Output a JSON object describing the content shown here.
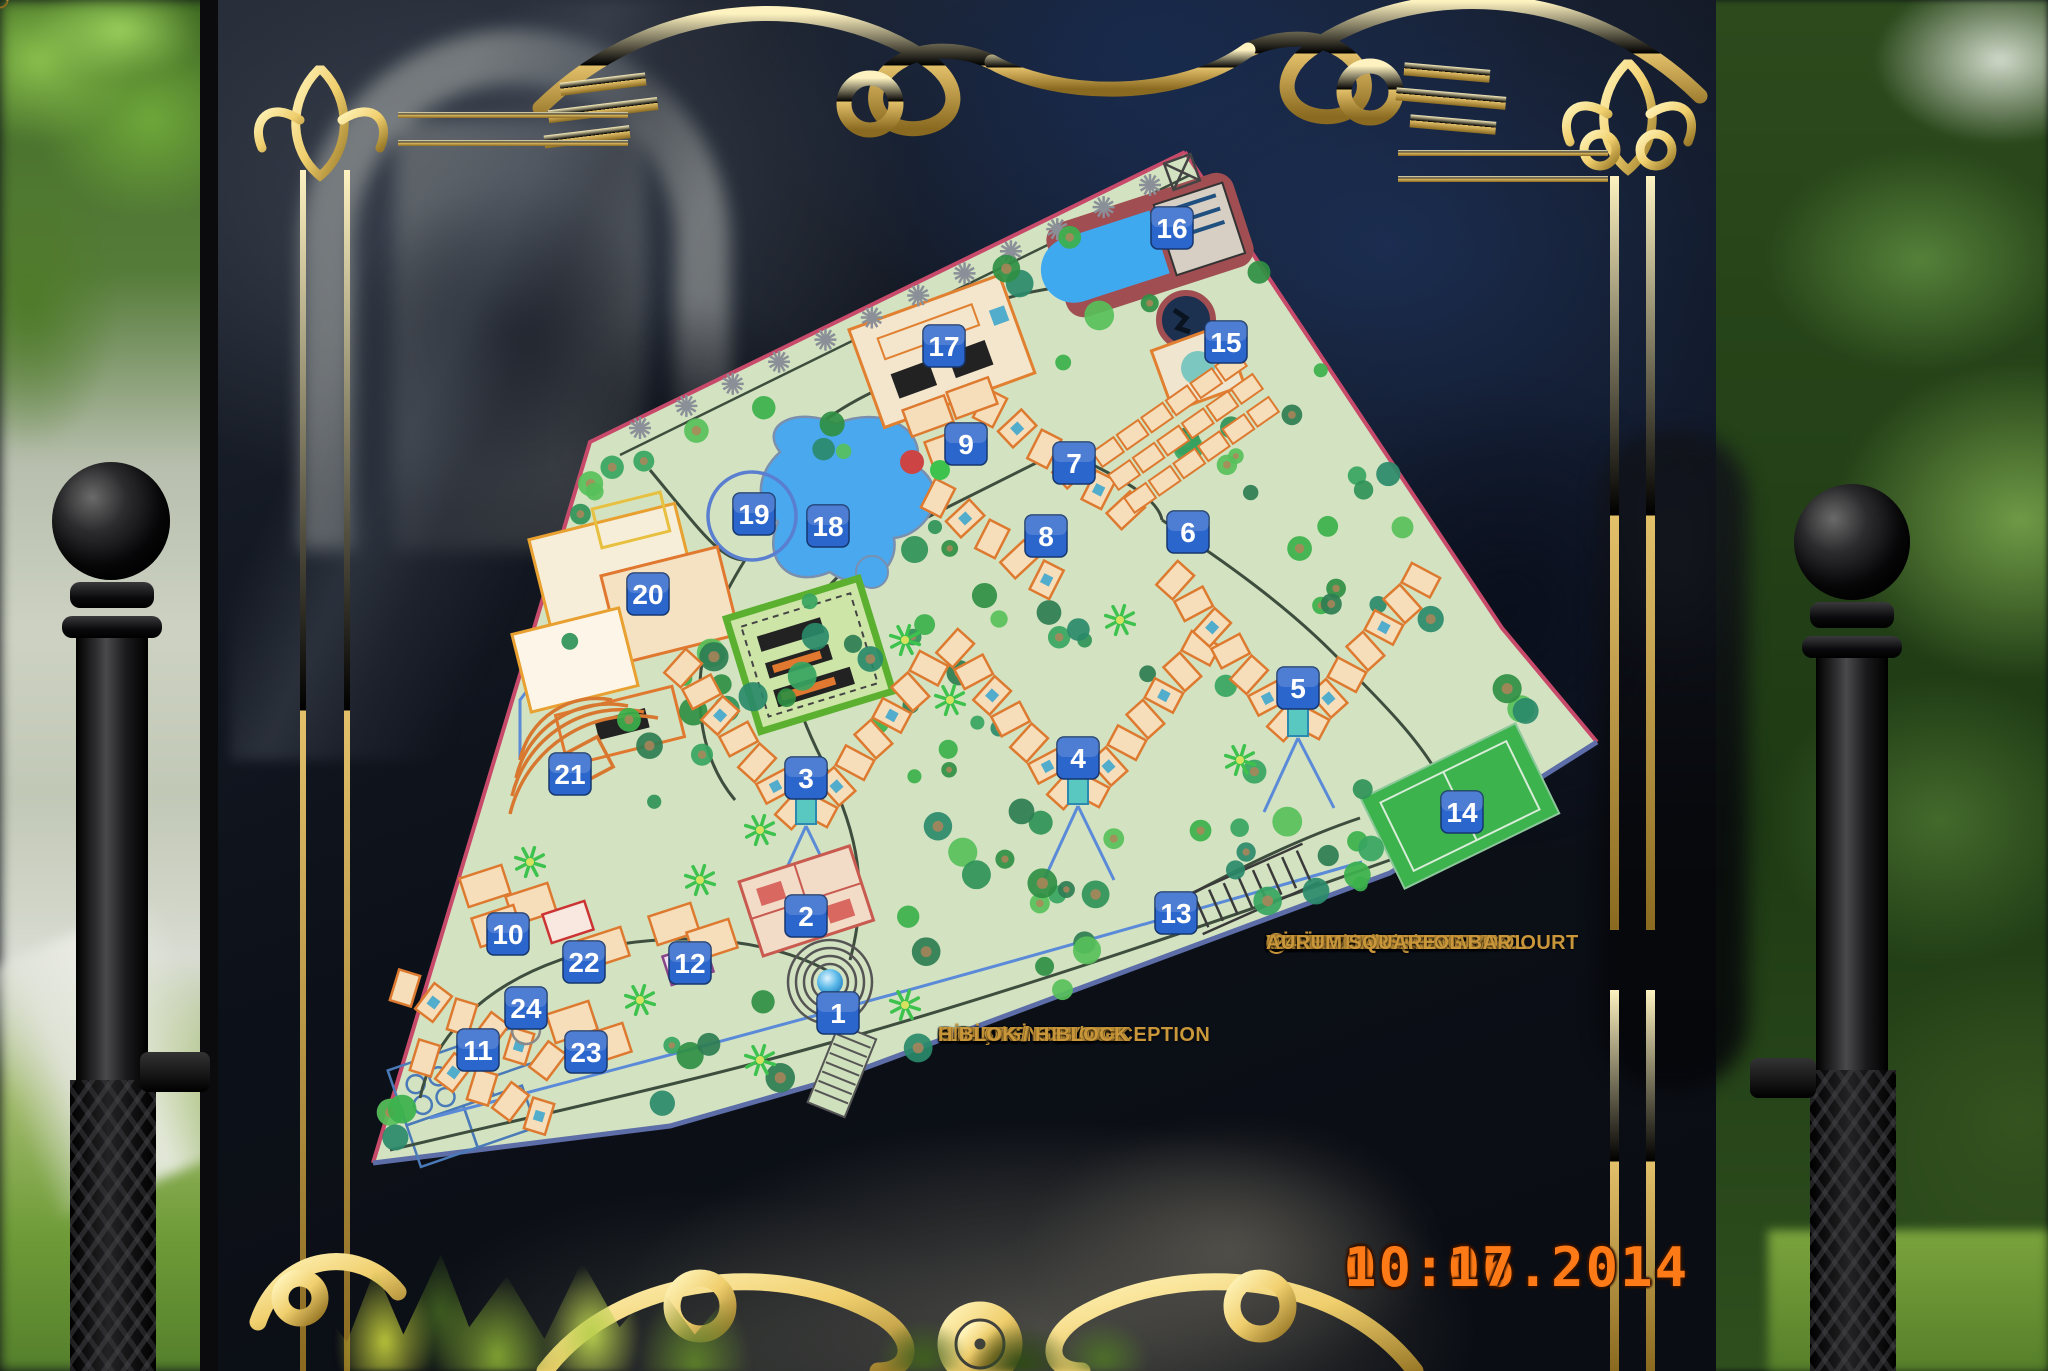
{
  "sign": {
    "legend_left": [
      {
        "n": "1-",
        "t": "GİRİŞ / ENTRY"
      },
      {
        "n": "2-",
        "t": "RESEPSİYON / RECEPTION"
      },
      {
        "n": "3-",
        "t": "A BLOK / A BLOCK"
      },
      {
        "n": "4-",
        "t": "B BLOK / B BLOCK"
      },
      {
        "n": "5-",
        "t": "C BLOK / C BLOCK"
      },
      {
        "n": "6-",
        "t": "D BLOK / D BLOCK"
      },
      {
        "n": "7-",
        "t": "E BLOK / E BLOCK"
      },
      {
        "n": "8-",
        "t": "F BLOK / F BLOCK"
      },
      {
        "n": "9-",
        "t": "G BLOK / G BLOCK"
      },
      {
        "n": "10-",
        "t": "H BLOK / H BLOCK"
      }
    ],
    "legend_right": [
      {
        "n": "11-",
        "t": "K BLOK / K BLOCK"
      },
      {
        "n": "12-",
        "t": "VAHA WELLNESS & SPA"
      },
      {
        "n": "13-",
        "t": "OTOPARK / CARPARK"
      },
      {
        "n": "14-",
        "t": "TENİS KORTU / TENNIS COURT"
      },
      {
        "n": "15-",
        "t": "MİNİCLUB / MINICLUB"
      },
      {
        "n": "16-",
        "t": "SU PARKI / AQUAPARK"
      },
      {
        "n": "17-",
        "t": "SNACK BAR"
      },
      {
        "n": "18-",
        "t": "HAVUZ / SWIMMING POOL"
      },
      {
        "n": "19-",
        "t": "HAVUZ BAR / POOL BAR"
      },
      {
        "n": "20-",
        "t": "RESTAURANT",
        "circle": "10"
      },
      {
        "n": "21-",
        "t": "AMPHITHEATRE"
      },
      {
        "n": "22-",
        "t": "CAFE BELLIS"
      },
      {
        "n": "23-",
        "t": "NORTH BAR"
      },
      {
        "n": "24-",
        "t": "AURUM SQUARE"
      }
    ],
    "timestamp": {
      "date": "08.06.2014",
      "time": "10:17"
    }
  },
  "map": {
    "markers": [
      {
        "num": "1",
        "x": 838,
        "y": 1013
      },
      {
        "num": "2",
        "x": 806,
        "y": 916
      },
      {
        "num": "3",
        "x": 806,
        "y": 778
      },
      {
        "num": "4",
        "x": 1078,
        "y": 758
      },
      {
        "num": "5",
        "x": 1298,
        "y": 688
      },
      {
        "num": "6",
        "x": 1188,
        "y": 532
      },
      {
        "num": "7",
        "x": 1074,
        "y": 463
      },
      {
        "num": "8",
        "x": 1046,
        "y": 536
      },
      {
        "num": "9",
        "x": 966,
        "y": 444
      },
      {
        "num": "10",
        "x": 508,
        "y": 934
      },
      {
        "num": "11",
        "x": 478,
        "y": 1050
      },
      {
        "num": "12",
        "x": 690,
        "y": 963
      },
      {
        "num": "13",
        "x": 1176,
        "y": 913
      },
      {
        "num": "14",
        "x": 1462,
        "y": 812
      },
      {
        "num": "15",
        "x": 1226,
        "y": 342
      },
      {
        "num": "16",
        "x": 1172,
        "y": 228
      },
      {
        "num": "17",
        "x": 944,
        "y": 346
      },
      {
        "num": "18",
        "x": 828,
        "y": 526
      },
      {
        "num": "19",
        "x": 754,
        "y": 514
      },
      {
        "num": "20",
        "x": 648,
        "y": 594
      },
      {
        "num": "21",
        "x": 570,
        "y": 774
      },
      {
        "num": "22",
        "x": 584,
        "y": 962
      },
      {
        "num": "23",
        "x": 586,
        "y": 1052
      },
      {
        "num": "24",
        "x": 526,
        "y": 1008
      }
    ],
    "colors": {
      "marker_blue": "#2b66cc",
      "parcel_green": "#d3e3c1",
      "water_blue": "#49a8ee",
      "gold": "#d9b45c",
      "legend_gold": "#c9973a",
      "timestamp_orange": "#fd7a16",
      "edge_pink": "#c84a6a"
    }
  }
}
